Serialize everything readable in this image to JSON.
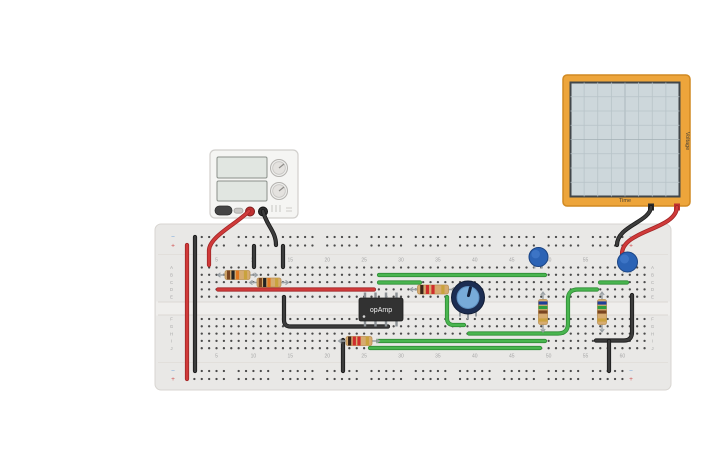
{
  "app": {
    "background": "#ffffff"
  },
  "colors": {
    "board_fill": "#e9e8e6",
    "board_stroke": "#d8d5d1",
    "board_gap": "#efeeec",
    "hole": "#4a4a4a",
    "groove": "#dcd8d4",
    "label": "#a6a6a6",
    "plus": "#d05050",
    "minus": "#6aa0d8",
    "wire_red": "#d03a3a",
    "wire_red_edge": "#a12626",
    "wire_black": "#3c3c3c",
    "wire_black_edge": "#191919",
    "wire_green": "#49b54f",
    "wire_green_edge": "#2f8c35",
    "lead": "#9aa0a4",
    "resistor_body": "#d6ab70",
    "resistor_edge": "#ba9053",
    "cap_fill": "#2b63b5",
    "cap_edge": "#1c4584",
    "cap_hi": "#4a83d2",
    "pot_ring": "#1c2d52",
    "pot_face": "#78abd9",
    "pot_pointer": "#13203b",
    "chip_fill": "#323232",
    "chip_pin": "#8d9296",
    "chip_text": "#f0f0f0",
    "psu_body": "#f5f5f3",
    "psu_edge": "#d1cfcc",
    "psu_screen": "#e1e6e1",
    "psu_screen_edge": "#8a908a",
    "psu_knob": "#ededeb",
    "psu_knob_edge": "#b4b2af",
    "scope_frame": "#eda53b",
    "scope_frame_edge": "#d18a22",
    "scope_screen": "#cdd7db",
    "scope_screen_edge": "#41464a",
    "scope_grid": "#b7c3c8",
    "scope_grid_major": "#a2afb5",
    "scope_text": "#4a4133"
  },
  "breadboard": {
    "x": 155,
    "y": 224,
    "w": 516,
    "h": 166,
    "cols": 63,
    "col1_x": 187,
    "pitch": 7.38,
    "rows_top_y": 267.5,
    "rows_bottom_y": 319,
    "row_pitch": 7.3,
    "rail_rows_top": [
      237,
      245.5
    ],
    "rail_rows_bottom": [
      371,
      379
    ],
    "rail_group_start_cols": [
      2,
      8,
      14,
      20,
      26,
      32,
      38,
      44,
      50,
      56
    ],
    "row_letters_top": [
      "A",
      "B",
      "C",
      "D",
      "E"
    ],
    "row_letters_bottom": [
      "F",
      "G",
      "H",
      "I",
      "J"
    ],
    "col_numbers": [
      5,
      10,
      15,
      20,
      25,
      30,
      35,
      40,
      45,
      50,
      55,
      60
    ],
    "plus_sign": "+",
    "minus_sign": "−"
  },
  "oscilloscope": {
    "time_label": "Time",
    "voltage_label": "Voltage",
    "grid_cols": 8,
    "grid_rows": 8
  },
  "opamp": {
    "label": "opAmp",
    "x": 359,
    "y": 298,
    "w": 44,
    "h": 23
  },
  "wires": [
    {
      "name": "psu-red-probe",
      "color": "red",
      "d": "M249,211 C238,223 210,236 209,250 L209,265"
    },
    {
      "name": "psu-black-probe",
      "color": "black",
      "d": "M263,211 C266,225 276,231 276,245"
    },
    {
      "name": "left-red-rail-jumper",
      "color": "red",
      "d": "M187,245 L187,379"
    },
    {
      "name": "left-black-rail-jumper",
      "color": "black",
      "d": "M195,237 L195,371"
    },
    {
      "name": "black-jumper-col10",
      "color": "black",
      "d": "M254,246 L254,267"
    },
    {
      "name": "black-jumper-col14",
      "color": "black",
      "d": "M283,246 L283,267"
    },
    {
      "name": "red-row-d-jumper",
      "color": "red",
      "d": "M218,289.5 L374,289.5"
    },
    {
      "name": "black-bent-jumper-left",
      "color": "black",
      "d": "M284,297 L284,320 Q284,326.5 290.5,326.5 L388,326.5"
    },
    {
      "name": "black-jumper-col23",
      "color": "black",
      "d": "M343,340 L343,371"
    },
    {
      "name": "green-row-b-jumper",
      "color": "green",
      "d": "M379,275 L545,275"
    },
    {
      "name": "green-row-c-left-jumper",
      "color": "green",
      "d": "M379,282.5 L420,282.5"
    },
    {
      "name": "green-pot-curve-jumper",
      "color": "green",
      "d": "M447,297 L447,318 Q447,325 454,325 L464,325"
    },
    {
      "name": "green-s-curve-jumper",
      "color": "green",
      "d": "M469,333.5 L558,333.5 Q568,333.5 568,323.5 L568,299 Q568,289.5 578,289.5 L597,289.5"
    },
    {
      "name": "green-row-i-jumper",
      "color": "green",
      "d": "M378,341 L545,341"
    },
    {
      "name": "green-row-j-jumper",
      "color": "green",
      "d": "M370,348 L540,348"
    },
    {
      "name": "green-row-c-right-jumper",
      "color": "green",
      "d": "M600,282.5 L627,282.5"
    },
    {
      "name": "black-bent-jumper-right",
      "color": "black",
      "d": "M596,340.5 L624,340.5 Q632,340.5 632,332 L632,295"
    },
    {
      "name": "black-jumper-col58",
      "color": "black",
      "d": "M609,341 L609,371"
    },
    {
      "name": "scope-black-probe",
      "color": "black",
      "d": "M651,207 C650,222 617,226 617,245"
    },
    {
      "name": "scope-red-probe",
      "color": "red",
      "d": "M677,207 C676,230 622,230 622,254"
    }
  ],
  "band_palettes": {
    "tenk": [
      "#7a4520",
      "#232323",
      "#e07820",
      "#c9a23d"
    ],
    "r22": [
      "#3a2418",
      "#cf2d2d",
      "#cf2d2d",
      "#c9a23d"
    ],
    "bgb": [
      "#1f3f9a",
      "#2f9e3f",
      "#7a4520",
      "#caa13f"
    ]
  },
  "resistors": [
    {
      "name": "resistor-row-b",
      "x": 237.5,
      "y": 275,
      "vertical": false,
      "len": 25,
      "bands": "tenk"
    },
    {
      "name": "resistor-row-c",
      "x": 269,
      "y": 282.5,
      "vertical": false,
      "len": 24,
      "bands": "tenk"
    },
    {
      "name": "resistor-row-d",
      "x": 433,
      "y": 289.5,
      "vertical": false,
      "len": 31,
      "bands": "r22"
    },
    {
      "name": "resistor-row-i",
      "x": 359,
      "y": 341,
      "vertical": false,
      "len": 26,
      "bands": "r22"
    },
    {
      "name": "resistor-vertical-a",
      "x": 543,
      "y": 312,
      "vertical": true,
      "len": 25,
      "bands": "bgb"
    },
    {
      "name": "resistor-vertical-b",
      "x": 602,
      "y": 312,
      "vertical": true,
      "len": 25,
      "bands": "bgb"
    }
  ],
  "capacitors": [
    {
      "name": "capacitor-a",
      "x": 538.5,
      "y": 257,
      "r": 9.5,
      "legs": [
        [
          534.5,
          268.5
        ],
        [
          542,
          268.5
        ]
      ]
    },
    {
      "name": "capacitor-b",
      "x": 627.5,
      "y": 262,
      "r": 10,
      "legs": [
        [
          623.5,
          272.5
        ],
        [
          630.5,
          272.5
        ]
      ]
    }
  ],
  "potentiometer": {
    "name": "potentiometer",
    "x": 468,
    "y": 297.5,
    "r": 16.5,
    "face_r": 11,
    "angle": 14
  }
}
